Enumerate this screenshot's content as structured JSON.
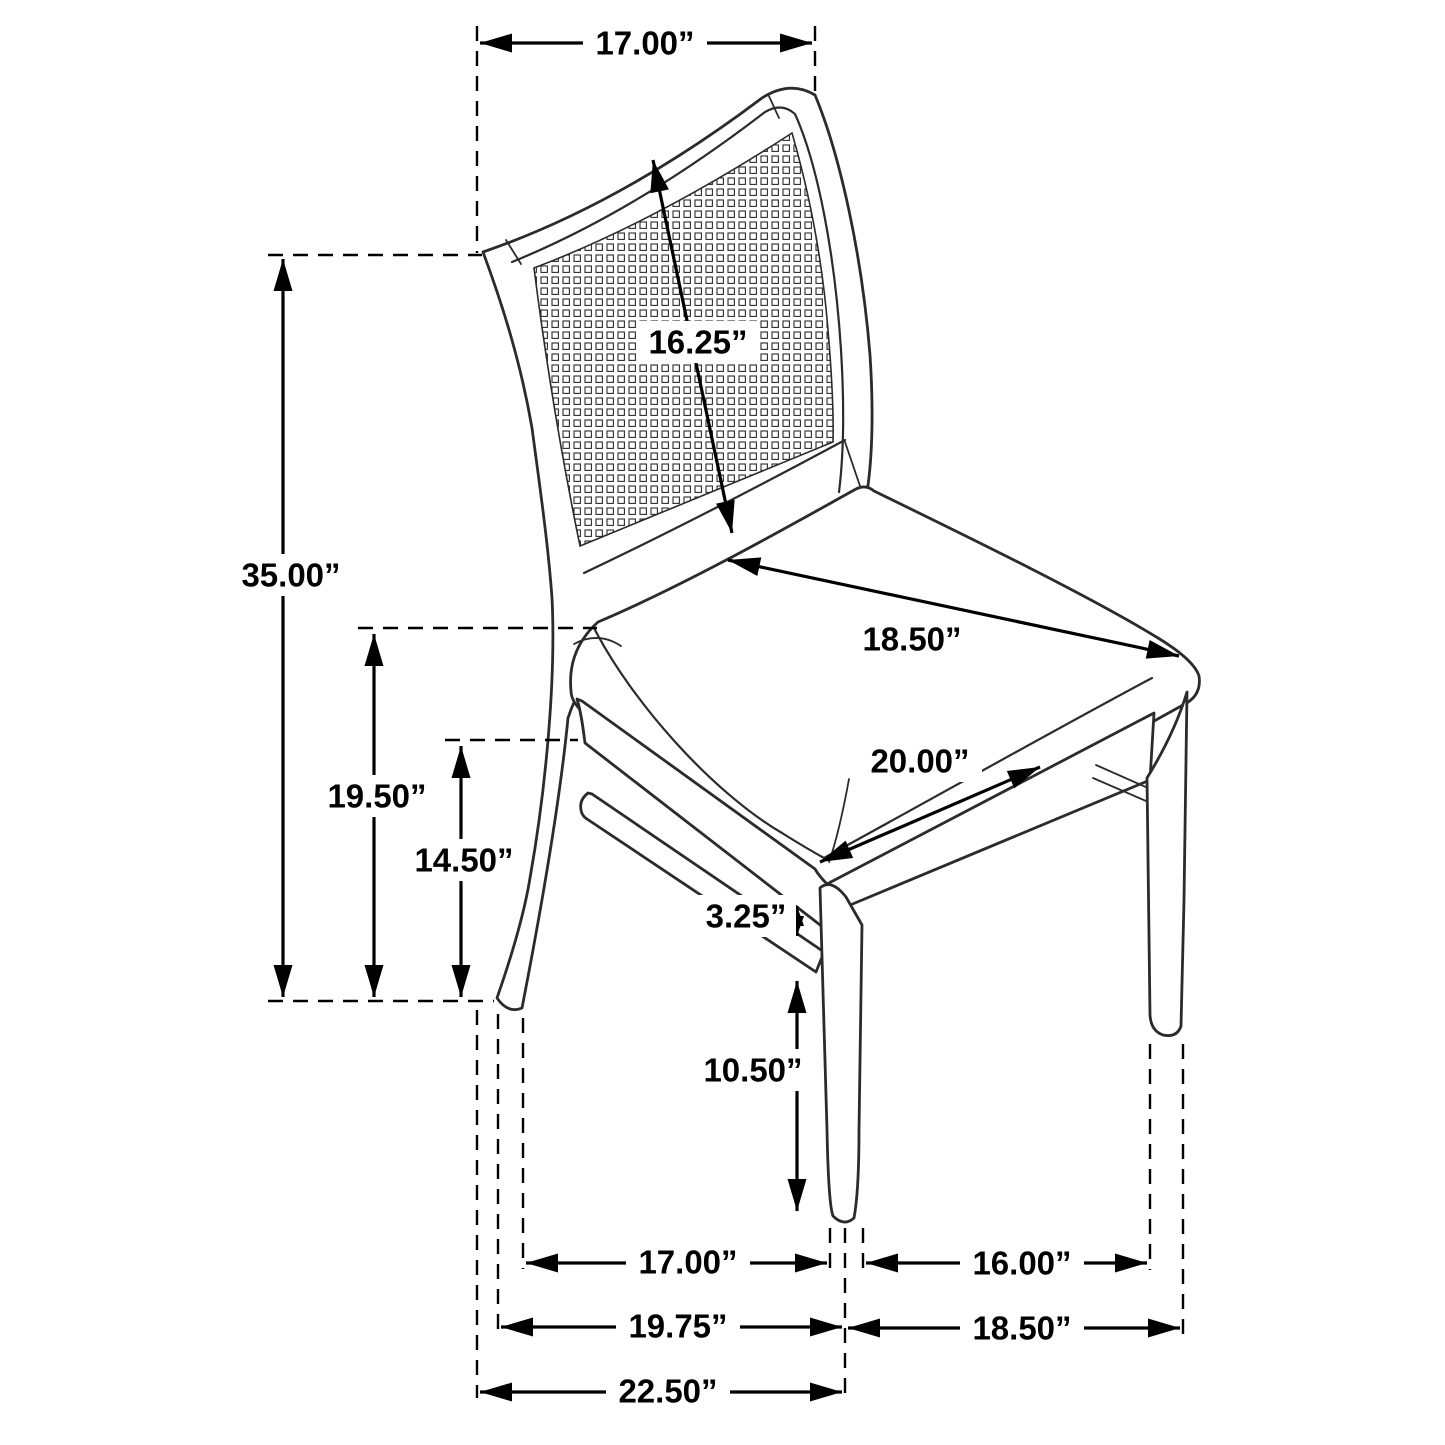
{
  "page": {
    "title": "Chair dimension diagram"
  },
  "diagram": {
    "subject": "cane-back dining side chair line drawing with dimensions",
    "background_color": "#ffffff",
    "chair_line_color": "#2b2b2b",
    "dimension_line_color": "#000000",
    "unit": "inches",
    "dimensions": {
      "back_top_width": "17.00”",
      "backrest_height": "16.25”",
      "overall_height": "35.00”",
      "seat_height": "19.50”",
      "seat_frame_height": "14.50”",
      "seat_depth": "18.50”",
      "seat_width": "20.00”",
      "apron_to_stretcher_gap": "3.25”",
      "front_leg_height": "10.50”",
      "leg_span_side": "17.00”",
      "leg_span_front": "16.00”",
      "footprint_depth_to_front_leg": "19.75”",
      "footprint_width": "18.50”",
      "overall_depth": "22.50”"
    }
  }
}
